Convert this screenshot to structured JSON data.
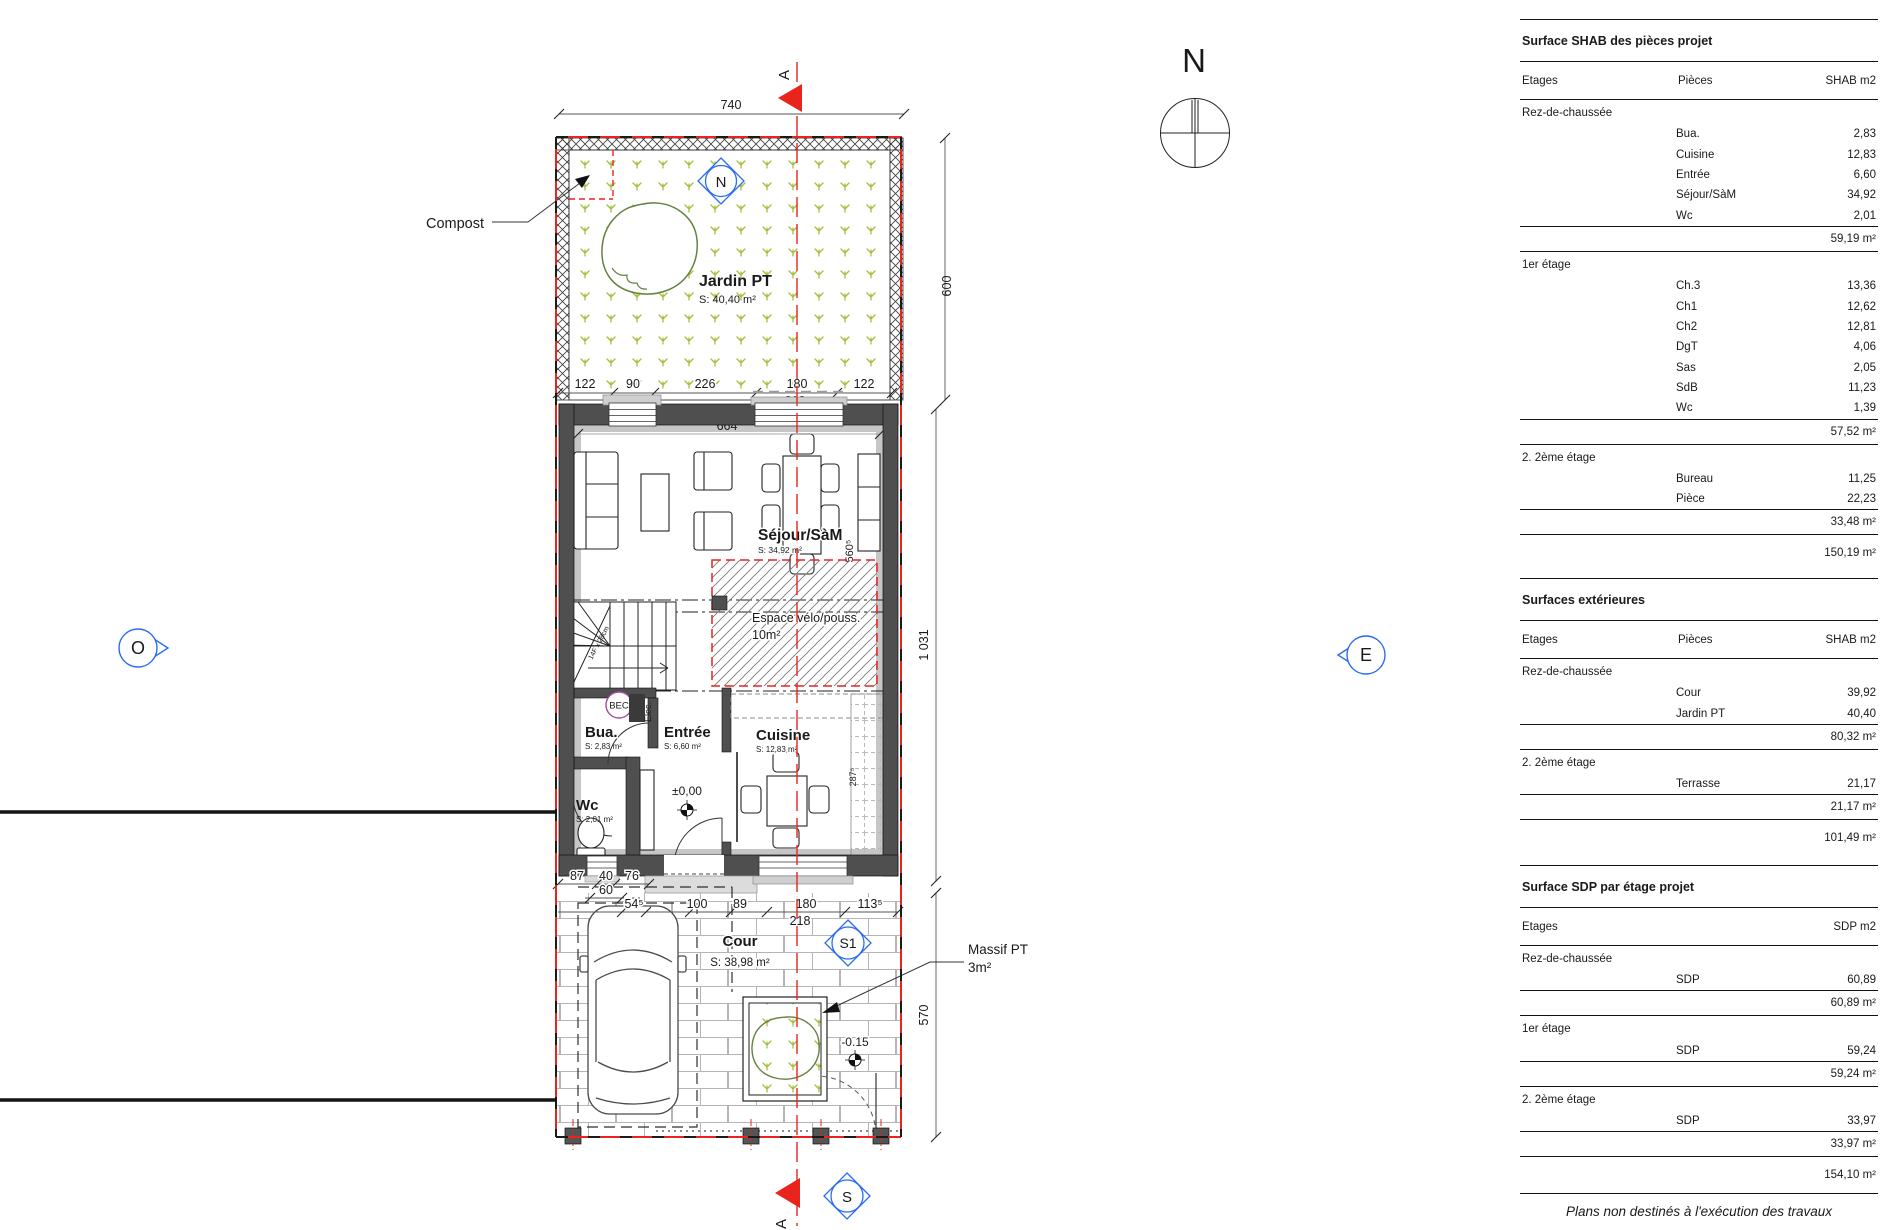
{
  "plan": {
    "compass": "N",
    "compost_label": "Compost",
    "markers": {
      "north": "N",
      "west": "O",
      "east": "E",
      "south": "S",
      "s1": "S1",
      "section_top": "A",
      "section_bottom": "A"
    },
    "rooms": {
      "jardin": {
        "name": "Jardin PT",
        "area": "S: 40,40 m²"
      },
      "sejour": {
        "name": "Séjour/SàM",
        "area": "S: 34,92 m²"
      },
      "bike": {
        "name": "Espace vélo/pouss.",
        "area": "10m²"
      },
      "bua": {
        "name": "Bua.",
        "area": "S: 2,83 m²"
      },
      "entree": {
        "name": "Entrée",
        "area": "S: 6,60 m²"
      },
      "cuisine": {
        "name": "Cuisine",
        "area": "S: 12,83 m²"
      },
      "wc": {
        "name": "Wc",
        "area": "S: 2,01 m²"
      },
      "cour": {
        "name": "Cour",
        "area": "S: 38,98 m²"
      },
      "massif": {
        "name": "Massif PT",
        "area": "3m²"
      }
    },
    "annotations": {
      "bec": "BEC",
      "elec": "Elec.",
      "stairs": "14F x 28cm",
      "level_entree": "±0,00",
      "level_cour": "-0.15"
    },
    "dims": {
      "top": "740",
      "garden_height": "600",
      "building_height": "1 031",
      "cour_height": "570",
      "garden_row": [
        "122",
        "90",
        "226",
        "180",
        "122"
      ],
      "garden_sub": [
        "218",
        "218"
      ],
      "interior_width": "664",
      "sejour_width": "560⁵",
      "kitchen_width": "287⁵",
      "wc_row": [
        "87",
        "40",
        "76"
      ],
      "door": "60",
      "cour_row": [
        "54⁵",
        "100",
        "89",
        "180",
        "113⁵"
      ],
      "cour_sub": "218"
    },
    "colors": {
      "red": "#e8241d",
      "blue": "#2a6cf0",
      "grass": "#a3bf3a",
      "wall": "#4f4f4f"
    }
  },
  "tables": [
    {
      "title": "Surface SHAB des pièces projet",
      "col1": "Etages",
      "col2": "Pièces",
      "col3": "SHAB m2",
      "groups": [
        {
          "etage": "Rez-de-chaussée",
          "rows": [
            [
              "Bua.",
              "2,83"
            ],
            [
              "Cuisine",
              "12,83"
            ],
            [
              "Entrée",
              "6,60"
            ],
            [
              "Séjour/SàM",
              "34,92"
            ],
            [
              "Wc",
              "2,01"
            ]
          ],
          "subtotal": "59,19 m²"
        },
        {
          "etage": "1er étage",
          "rows": [
            [
              "Ch.3",
              "13,36"
            ],
            [
              "Ch1",
              "12,62"
            ],
            [
              "Ch2",
              "12,81"
            ],
            [
              "DgT",
              "4,06"
            ],
            [
              "Sas",
              "2,05"
            ],
            [
              "SdB",
              "11,23"
            ],
            [
              "Wc",
              "1,39"
            ]
          ],
          "subtotal": "57,52 m²"
        },
        {
          "etage": "2. 2ème étage",
          "rows": [
            [
              "Bureau",
              "11,25"
            ],
            [
              "Pièce",
              "22,23"
            ]
          ],
          "subtotal": "33,48 m²"
        }
      ],
      "total": "150,19 m²"
    },
    {
      "title": "Surfaces extérieures",
      "col1": "Etages",
      "col2": "Pièces",
      "col3": "SHAB m2",
      "groups": [
        {
          "etage": "Rez-de-chaussée",
          "rows": [
            [
              "Cour",
              "39,92"
            ],
            [
              "Jardin PT",
              "40,40"
            ]
          ],
          "subtotal": "80,32 m²"
        },
        {
          "etage": "2. 2ème étage",
          "rows": [
            [
              "Terrasse",
              "21,17"
            ]
          ],
          "subtotal": "21,17 m²"
        }
      ],
      "total": "101,49 m²"
    },
    {
      "title": "Surface SDP par étage projet",
      "col1": "Etages",
      "col2": "",
      "col3": "SDP m2",
      "groups": [
        {
          "etage": "Rez-de-chaussée",
          "rows": [
            [
              "SDP",
              "60,89"
            ]
          ],
          "subtotal": "60,89 m²"
        },
        {
          "etage": "1er étage",
          "rows": [
            [
              "SDP",
              "59,24"
            ]
          ],
          "subtotal": "59,24 m²"
        },
        {
          "etage": "2. 2ème étage",
          "rows": [
            [
              "SDP",
              "33,97"
            ]
          ],
          "subtotal": "33,97 m²"
        }
      ],
      "total": "154,10 m²"
    }
  ],
  "footer": "Plans non destinés à l'exécution des travaux"
}
